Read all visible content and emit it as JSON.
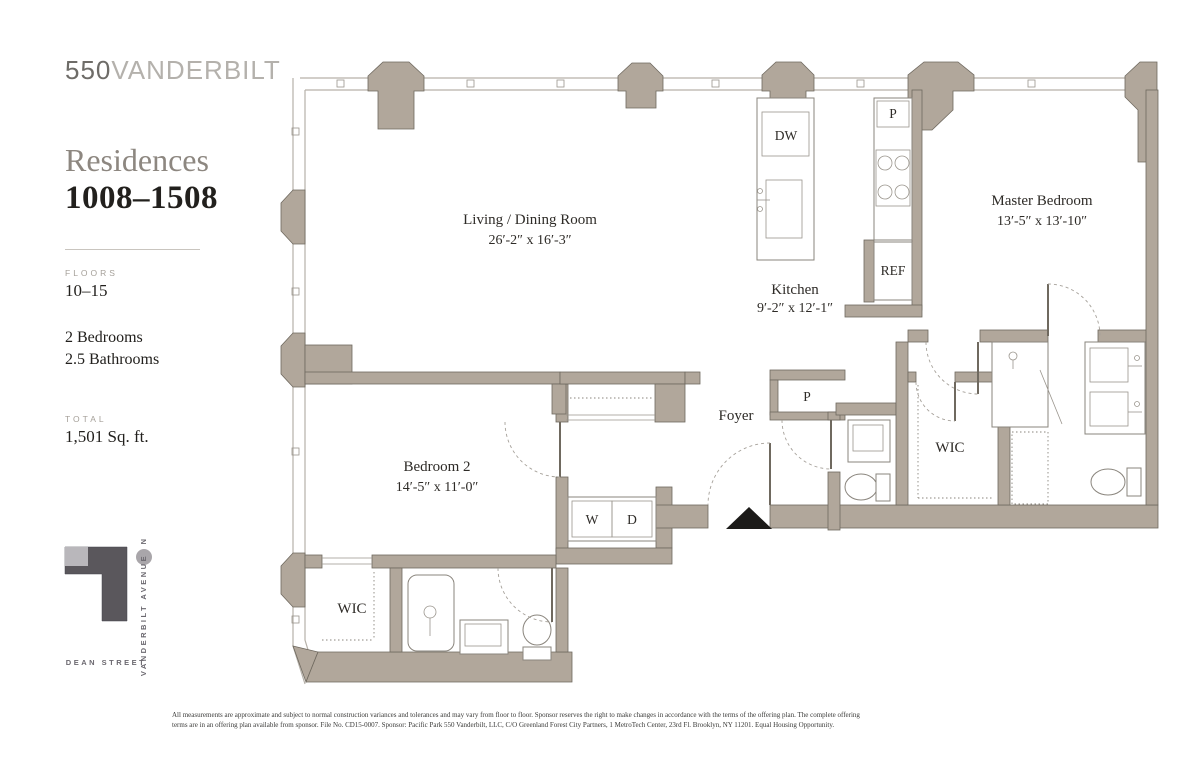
{
  "sidebar": {
    "logo": {
      "number": "550",
      "name": "VANDERBILT"
    },
    "title": "Residences",
    "range": "1008–1508",
    "floors_label": "FLOORS",
    "floors": "10–15",
    "bedrooms": "2 Bedrooms",
    "bathrooms": "2.5 Bathrooms",
    "total_label": "TOTAL",
    "total": "1,501 Sq. ft.",
    "map": {
      "north": "N",
      "avenue": "VANDERBILT AVENUE",
      "street": "DEAN STREET"
    }
  },
  "plan": {
    "rooms": [
      {
        "name": "Living / Dining Room",
        "dims": "26′-2″ x 16′-3″"
      },
      {
        "name": "Kitchen",
        "dims": "9′-2″ x 12′-1″"
      },
      {
        "name": "Master Bedroom",
        "dims": "13′-5″ x 13′-10″"
      },
      {
        "name": "Bedroom 2",
        "dims": "14′-5″ x 11′-0″"
      }
    ],
    "labels": {
      "foyer": "Foyer",
      "wic_master": "WIC",
      "wic_bedroom2": "WIC",
      "washer": "W",
      "dryer": "D",
      "dishwasher": "DW",
      "pantry": "P",
      "closet": "P",
      "refrigerator": "REF"
    }
  },
  "colors": {
    "wall": "#b1a79b",
    "footprint": "#5a575c",
    "footprint_light": "#b9b7bb"
  },
  "disclaimer": {
    "line1": "All measurements are approximate and subject to normal construction variances and tolerances and may vary from floor to floor. Sponsor reserves the right to make changes in accordance with the terms of the offering plan. The complete offering",
    "line2": "terms are in an offering plan available from sponsor. File No. CD15-0007. Sponsor: Pacific Park 550 Vanderbilt, LLC, C/O Greenland Forest City Partners, 1 MetroTech Center, 23rd Fl. Brooklyn, NY 11201. Equal Housing Opportunity."
  }
}
